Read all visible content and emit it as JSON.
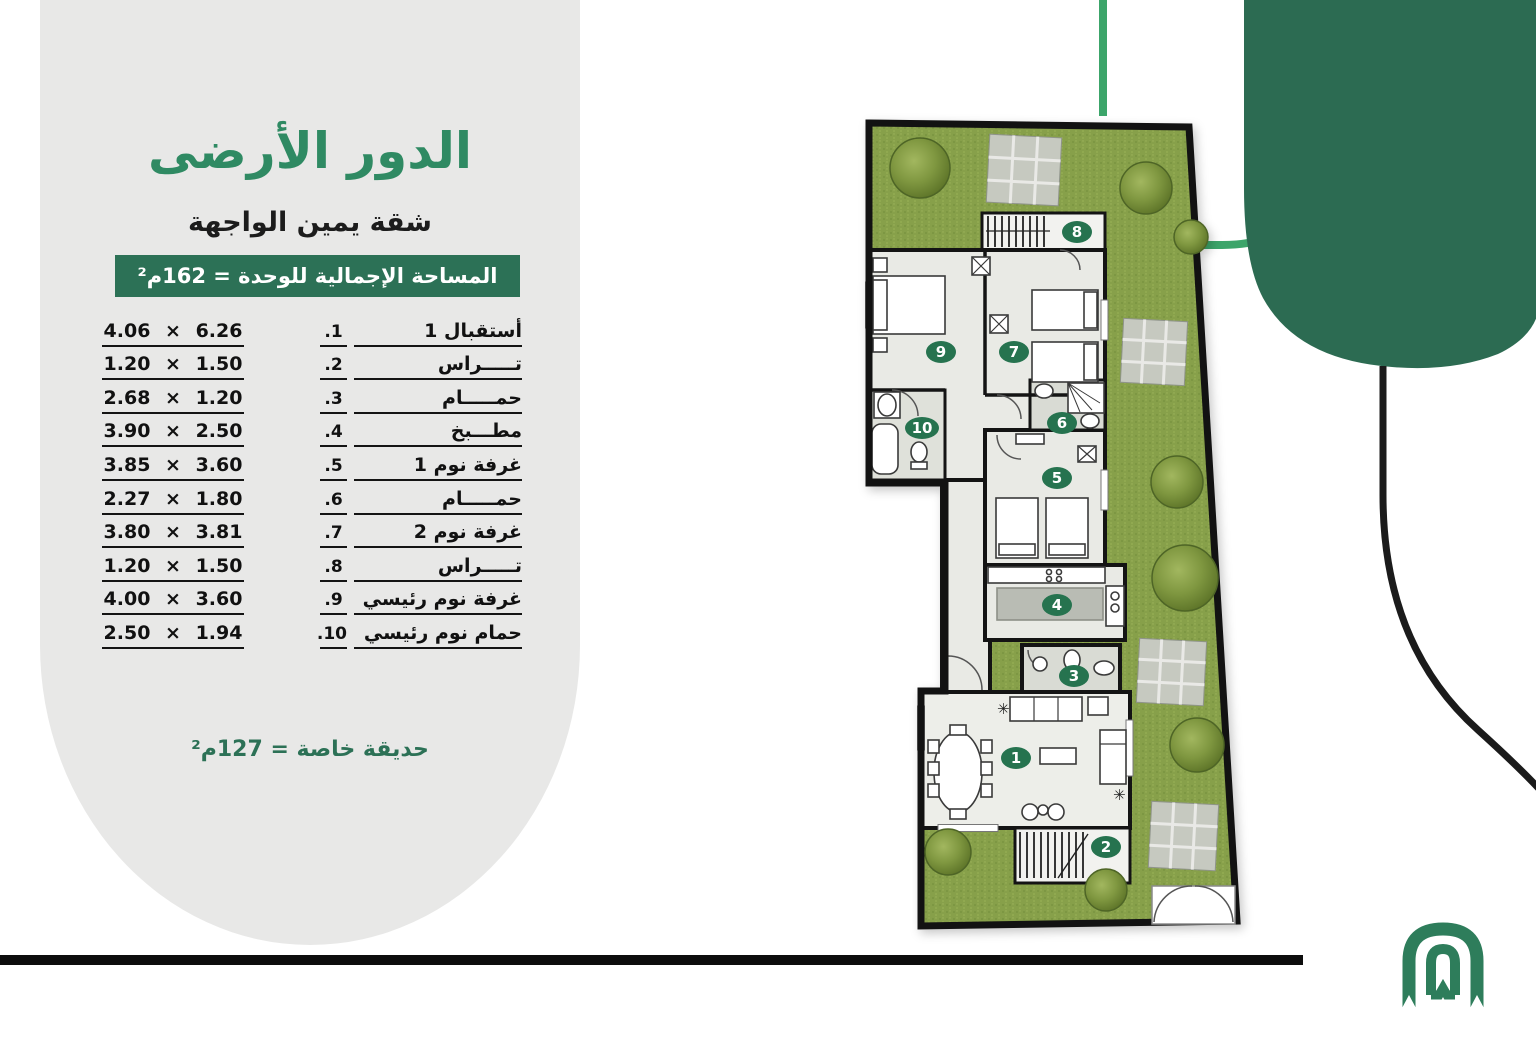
{
  "panel": {
    "title": "الدور الأرضى",
    "subtitle": "شقة يمين الواجهة",
    "area_banner": "المساحة الإجمالية للوحدة = 162م²",
    "garden_note": "حديقة خاصة = 127م²",
    "rooms": [
      {
        "no": "1.",
        "name": "أستقبال 1",
        "dims": "4.06 × 6.26"
      },
      {
        "no": "2.",
        "name": "تـــــراس",
        "dims": "1.20 × 1.50"
      },
      {
        "no": "3.",
        "name": "حمـــــام",
        "dims": "2.68 × 1.20"
      },
      {
        "no": "4.",
        "name": "مطـــبخ",
        "dims": "3.90 × 2.50"
      },
      {
        "no": "5.",
        "name": "غرفة نوم 1",
        "dims": "3.85 × 3.60"
      },
      {
        "no": "6.",
        "name": "حمـــــام",
        "dims": "2.27 × 1.80"
      },
      {
        "no": "7.",
        "name": "غرفة نوم 2",
        "dims": "3.80 × 3.81"
      },
      {
        "no": "8.",
        "name": "تـــــراس",
        "dims": "1.20 × 1.50"
      },
      {
        "no": "9.",
        "name": "غرفة نوم رئيسي",
        "dims": "4.00 × 3.60"
      },
      {
        "no": "10.",
        "name": "حمام نوم رئيسي",
        "dims": "2.50 × 1.94"
      }
    ]
  },
  "plan": {
    "badges": [
      "1",
      "2",
      "3",
      "4",
      "5",
      "6",
      "7",
      "8",
      "9",
      "10"
    ]
  },
  "colors": {
    "accent_green": "#2f8a63",
    "banner_green": "#2c7156",
    "dark_green": "#2c6b52",
    "line_green": "#3ca56a",
    "badge_green": "#26734f",
    "logo_green": "#2e7d5b",
    "panel_gray": "#e8e8e7"
  }
}
